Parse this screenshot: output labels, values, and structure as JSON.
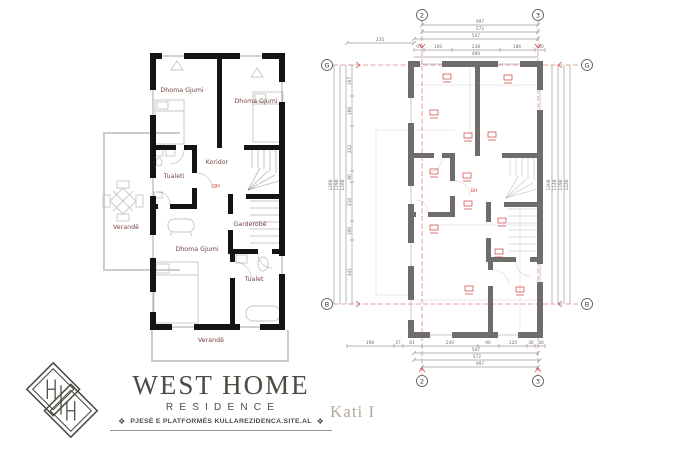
{
  "left_plan": {
    "labels": {
      "bedroom_tl": "Dhoma Gjumi",
      "bedroom_tr": "Dhoma Gjumi",
      "corridor": "Koridor",
      "toilet_upper": "Tualeti",
      "veranda_left": "Verandë",
      "wardrobe": "Garderobë",
      "bedroom_main": "Dhoma Gjumi",
      "toilet_lower": "Tualet",
      "veranda_bottom": "Verandë",
      "door_marker": "DH"
    },
    "colors": {
      "wall": "#141414",
      "room_label": "#7a4444",
      "furniture": "#c6c6c6",
      "marker_red": "#d63a3a",
      "veranda_line": "#cccccc"
    }
  },
  "right_plan": {
    "grid_bubbles": {
      "top_left": "2",
      "top_right": "3",
      "bottom_left": "2",
      "bottom_right": "3",
      "left_top": "G",
      "left_bottom": "B",
      "right_top": "G",
      "right_bottom": "B"
    },
    "dims_top": [
      "997",
      "572",
      "547",
      "490"
    ],
    "dim_offset_left": "235",
    "dims_top_segments": [
      "97",
      "100",
      "238",
      "186",
      "40"
    ],
    "dims_bottom_segments": [
      "198",
      "37",
      "81",
      "240",
      "90",
      "120",
      "36",
      "40"
    ],
    "dims_bottom": [
      "547",
      "572",
      "997"
    ],
    "dims_left_totals": [
      "1280",
      "1190",
      "1160"
    ],
    "dims_left_segments": [
      "167",
      "160",
      "242",
      "60",
      "210",
      "100",
      "341"
    ],
    "dims_right_totals": [
      "1200",
      "1140",
      "1190",
      "1220"
    ],
    "marker": "DH",
    "colors": {
      "wall": "#6f6c6c",
      "axis_red": "#e08585",
      "dim_line": "#9a9a9a",
      "tag_red": "#cf3d3d"
    }
  },
  "branding": {
    "title": "WEST HOME",
    "subtitle": "RESIDENCE",
    "tagline": "PJESË E PLATFORMËS KULLAREZIDENCA.SITE.AL",
    "ornament": "❖",
    "color": "#4c4c44"
  },
  "caption": {
    "floor_label": "Kati I"
  }
}
